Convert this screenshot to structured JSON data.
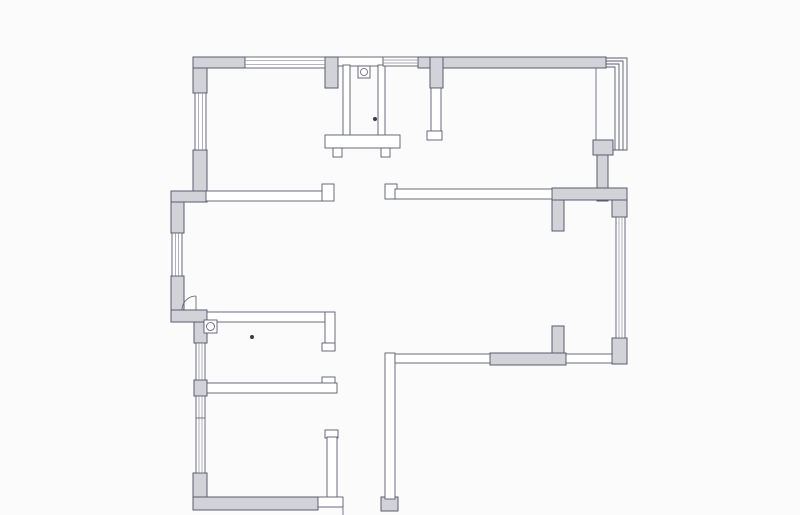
{
  "canvas": {
    "width": 800,
    "height": 515,
    "background": "#fbfbfc"
  },
  "palette": {
    "wall_fill": "#d2d2d9",
    "line": "#5b5b6e",
    "line_soft": "#8a8a9a",
    "white": "#ffffff",
    "dot": "#3a3a48"
  },
  "floor_plan": {
    "gray_walls": [
      {
        "name": "top-left-corner-pier",
        "x": 193,
        "y": 57,
        "w": 14,
        "h": 36
      },
      {
        "name": "top-wall-a",
        "x": 193,
        "y": 57,
        "w": 52,
        "h": 11
      },
      {
        "name": "bath-left-pier",
        "x": 325,
        "y": 57,
        "w": 13,
        "h": 31
      },
      {
        "name": "top-wall-b",
        "x": 418,
        "y": 57,
        "w": 25,
        "h": 11
      },
      {
        "name": "corridor-pier",
        "x": 430,
        "y": 57,
        "w": 13,
        "h": 31
      },
      {
        "name": "top-wall-c",
        "x": 443,
        "y": 57,
        "w": 163,
        "h": 11
      },
      {
        "name": "bay-sill-block",
        "x": 593,
        "y": 140,
        "w": 20,
        "h": 15
      },
      {
        "name": "right-wall-upper",
        "x": 597,
        "y": 155,
        "w": 11,
        "h": 46
      },
      {
        "name": "right-mid-wall",
        "x": 552,
        "y": 188,
        "w": 75,
        "h": 12
      },
      {
        "name": "right-mid-stub-down",
        "x": 552,
        "y": 200,
        "w": 12,
        "h": 31
      },
      {
        "name": "right-edge-block-upper",
        "x": 612,
        "y": 200,
        "w": 15,
        "h": 17
      },
      {
        "name": "right-edge-block-lower",
        "x": 612,
        "y": 338,
        "w": 15,
        "h": 26
      },
      {
        "name": "bottom-right-wall-gray",
        "x": 490,
        "y": 353,
        "w": 76,
        "h": 12
      },
      {
        "name": "bottom-right-stub-up",
        "x": 552,
        "y": 326,
        "w": 12,
        "h": 27
      },
      {
        "name": "left-wall-seg1",
        "x": 193,
        "y": 150,
        "w": 14,
        "h": 42
      },
      {
        "name": "left-jog-upper",
        "x": 171,
        "y": 191,
        "w": 36,
        "h": 11
      },
      {
        "name": "left-wall-outer-seg1",
        "x": 171,
        "y": 202,
        "w": 13,
        "h": 31
      },
      {
        "name": "left-wall-outer-seg2",
        "x": 171,
        "y": 276,
        "w": 13,
        "h": 36
      },
      {
        "name": "left-jog-lower",
        "x": 171,
        "y": 310,
        "w": 36,
        "h": 12
      },
      {
        "name": "left-wall-seg2",
        "x": 194,
        "y": 322,
        "w": 13,
        "h": 21
      },
      {
        "name": "left-wall-seg3",
        "x": 194,
        "y": 380,
        "w": 13,
        "h": 16
      },
      {
        "name": "bottom-left-corner-pier",
        "x": 193,
        "y": 473,
        "w": 14,
        "h": 37
      },
      {
        "name": "bottom-wall-gray",
        "x": 193,
        "y": 497,
        "w": 125,
        "h": 13
      },
      {
        "name": "entry-foot-block",
        "x": 381,
        "y": 497,
        "w": 17,
        "h": 14
      }
    ],
    "thin_walls": [
      {
        "name": "top-wall-bath",
        "x": 338,
        "y": 57,
        "w": 45,
        "h": 9
      },
      {
        "name": "bath-wall-left",
        "x": 343,
        "y": 65,
        "w": 7,
        "h": 72
      },
      {
        "name": "bath-wall-right",
        "x": 378,
        "y": 65,
        "w": 7,
        "h": 72
      },
      {
        "name": "bath-wall-bottom",
        "x": 325,
        "y": 135,
        "w": 75,
        "h": 13
      },
      {
        "name": "bath-foot-left",
        "x": 333,
        "y": 148,
        "w": 9,
        "h": 9
      },
      {
        "name": "bath-foot-right",
        "x": 381,
        "y": 148,
        "w": 9,
        "h": 9
      },
      {
        "name": "corridor-wall",
        "x": 431,
        "y": 88,
        "w": 10,
        "h": 45
      },
      {
        "name": "corridor-wall-hook",
        "x": 427,
        "y": 131,
        "w": 15,
        "h": 9
      },
      {
        "name": "hall-wall-left",
        "x": 206,
        "y": 191,
        "w": 118,
        "h": 10
      },
      {
        "name": "hall-wall-left-end",
        "x": 322,
        "y": 184,
        "w": 12,
        "h": 17
      },
      {
        "name": "hall-wall-right-end",
        "x": 385,
        "y": 184,
        "w": 12,
        "h": 15
      },
      {
        "name": "hall-wall-right",
        "x": 395,
        "y": 189,
        "w": 157,
        "h": 10
      },
      {
        "name": "bedroom2-wall-top",
        "x": 207,
        "y": 312,
        "w": 118,
        "h": 10
      },
      {
        "name": "bedroom2-wall-right-upper",
        "x": 325,
        "y": 312,
        "w": 10,
        "h": 38
      },
      {
        "name": "bedroom2-door-hook-upper",
        "x": 322,
        "y": 343,
        "w": 13,
        "h": 8
      },
      {
        "name": "bedroom2-wall-right-block",
        "x": 322,
        "y": 377,
        "w": 13,
        "h": 16
      },
      {
        "name": "bedroom2-wall-bottom",
        "x": 207,
        "y": 383,
        "w": 130,
        "h": 10
      },
      {
        "name": "bedroom3-door-hook",
        "x": 325,
        "y": 430,
        "w": 13,
        "h": 8
      },
      {
        "name": "bedroom3-wall-right",
        "x": 327,
        "y": 437,
        "w": 10,
        "h": 61
      },
      {
        "name": "bottom-wall-thin",
        "x": 318,
        "y": 497,
        "w": 25,
        "h": 10
      },
      {
        "name": "entry-leg-wall",
        "x": 385,
        "y": 353,
        "w": 10,
        "h": 146
      },
      {
        "name": "bottom-right-wall-thin-left",
        "x": 395,
        "y": 354,
        "w": 95,
        "h": 9
      },
      {
        "name": "bottom-right-wall-thin-right",
        "x": 566,
        "y": 354,
        "w": 46,
        "h": 9
      }
    ],
    "windows": [
      {
        "name": "window-top",
        "x": 245,
        "y": 57,
        "w": 80,
        "h": 11,
        "orient": "h"
      },
      {
        "name": "window-top-small",
        "x": 383,
        "y": 57,
        "w": 35,
        "h": 9,
        "orient": "h"
      },
      {
        "name": "window-left-1",
        "x": 195,
        "y": 93,
        "w": 11,
        "h": 57,
        "orient": "v"
      },
      {
        "name": "window-left-2",
        "x": 172,
        "y": 233,
        "w": 10,
        "h": 43,
        "orient": "v"
      },
      {
        "name": "window-left-3",
        "x": 196,
        "y": 343,
        "w": 9,
        "h": 37,
        "orient": "v"
      },
      {
        "name": "window-left-4",
        "x": 196,
        "y": 396,
        "w": 9,
        "h": 77,
        "orient": "v"
      },
      {
        "name": "window-right",
        "x": 616,
        "y": 217,
        "w": 9,
        "h": 121,
        "orient": "v"
      }
    ],
    "bay_window_polylines": [
      [
        [
          606,
          58
        ],
        [
          627,
          58
        ],
        [
          627,
          150
        ],
        [
          613,
          150
        ]
      ],
      [
        [
          606,
          61
        ],
        [
          623,
          61
        ],
        [
          623,
          150
        ]
      ],
      [
        [
          606,
          64
        ],
        [
          619,
          64
        ],
        [
          619,
          150
        ]
      ],
      [
        [
          606,
          67
        ],
        [
          615,
          67
        ],
        [
          615,
          150
        ]
      ]
    ],
    "lines": [
      {
        "name": "bay-inner-line",
        "x1": 596,
        "y1": 68,
        "x2": 596,
        "y2": 140
      },
      {
        "name": "window-left-4-divider",
        "x1": 196,
        "y1": 418,
        "x2": 205,
        "y2": 418
      },
      {
        "name": "entry-door-frame-line",
        "x1": 343,
        "y1": 505,
        "x2": 343,
        "y2": 515
      }
    ],
    "door_arcs": [
      {
        "name": "left-door-arc",
        "path": "M196,296 A14,14 0 0 0 182,310",
        "leaf": {
          "x1": 196,
          "y1": 296,
          "x2": 196,
          "y2": 310
        }
      }
    ],
    "fixtures": [
      {
        "name": "bath-fixture-symbol",
        "x": 358,
        "y": 66,
        "size": 12,
        "cx": 364,
        "cy": 72,
        "r": 3.5
      },
      {
        "name": "bedroom2-fixture-symbol",
        "x": 204,
        "y": 320,
        "size": 13,
        "cx": 210.5,
        "cy": 326.5,
        "r": 4
      }
    ],
    "dots": [
      {
        "name": "bath-dot",
        "cx": 375,
        "cy": 119,
        "r": 2
      },
      {
        "name": "bedroom2-dot",
        "cx": 252,
        "cy": 337,
        "r": 2
      }
    ]
  }
}
